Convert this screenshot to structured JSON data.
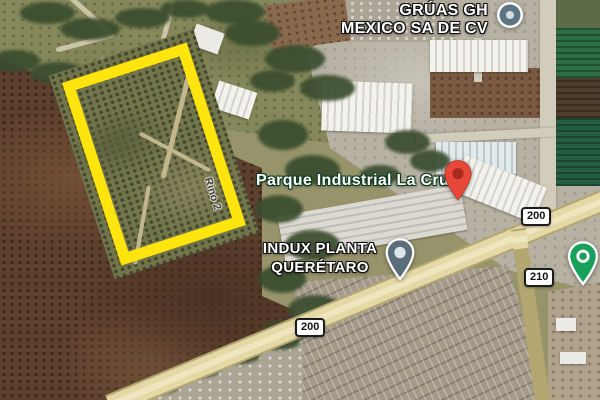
{
  "map": {
    "view": "satellite",
    "labels": {
      "gruas": {
        "line1": "GRÚAS GH",
        "line2": "MEXICO SA DE CV"
      },
      "parque": {
        "text": "Parque Industrial La Cruz"
      },
      "indux": {
        "line1": "INDUX PLANTA",
        "line2": "QUERÉTARO"
      },
      "street": {
        "text": "Rino 2"
      }
    },
    "shields": [
      {
        "label": "200"
      },
      {
        "label": "210"
      },
      {
        "label": "200"
      }
    ],
    "pins": {
      "gruas_place": {
        "kind": "business-circle",
        "color": "#5d7485"
      },
      "parque_place": {
        "kind": "red-marker",
        "color": "#e8483a"
      },
      "indux_place": {
        "kind": "teardrop",
        "color": "#5a6e79"
      },
      "park_place": {
        "kind": "teardrop",
        "color": "#16a05a"
      }
    },
    "highlight": {
      "shape": "rectangle-outline",
      "color": "#ffe50d"
    }
  }
}
